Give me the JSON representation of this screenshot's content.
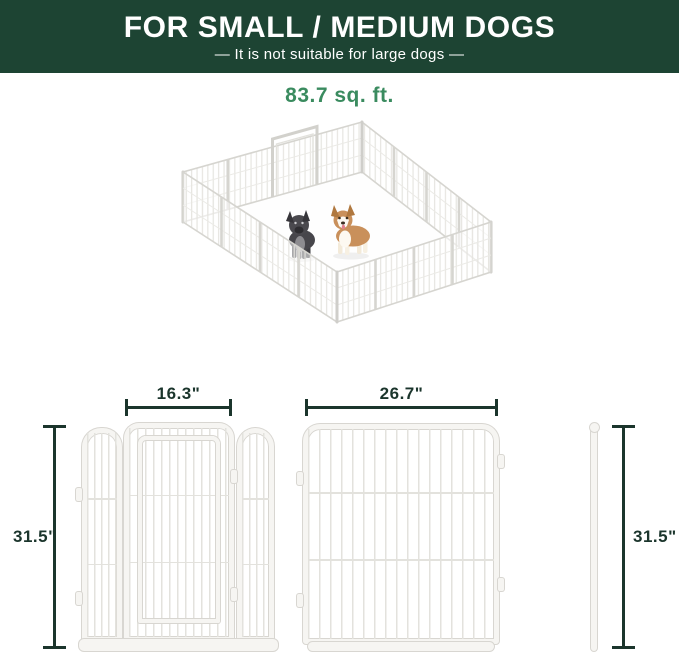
{
  "header": {
    "title": "FOR SMALL / MEDIUM DOGS",
    "subtitle": "—  It is not suitable for large dogs  —"
  },
  "area_label": "83.7 sq. ft.",
  "diagrams": {
    "door_width_label": "16.3\"",
    "panel_width_label": "26.7\"",
    "left_height_label": "31.5\"",
    "stake_height_label": "31.5\""
  },
  "illustration": {
    "icons": [
      "playpen-isometric-illustration",
      "french-bulldog-icon",
      "corgi-icon"
    ]
  },
  "colors": {
    "header_bg": "#1d4433",
    "header_text": "#ffffff",
    "area_text": "#3a8b5f",
    "dim": "#1b352c",
    "frame": "#d8d6d1",
    "mesh": "#e3e2dd"
  }
}
